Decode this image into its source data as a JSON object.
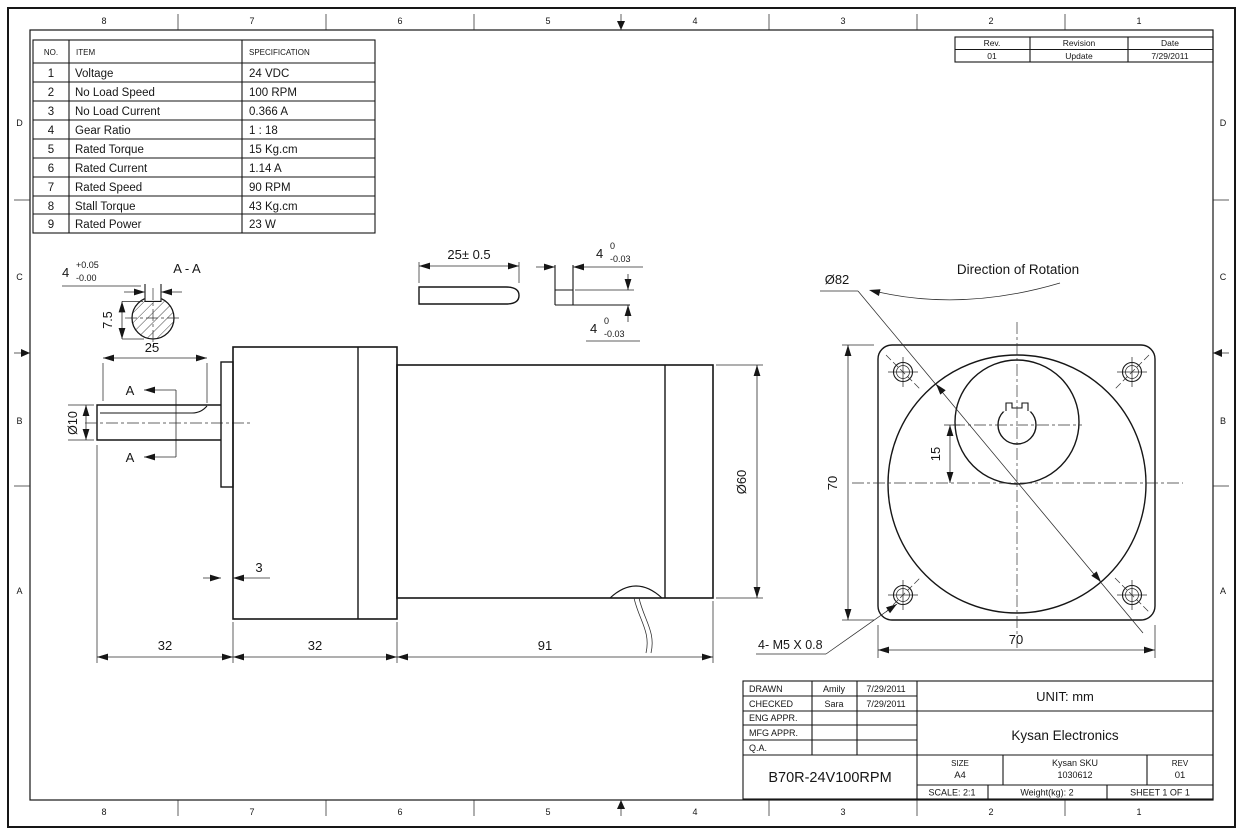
{
  "border": {
    "cols": [
      "8",
      "7",
      "6",
      "5",
      "4",
      "3",
      "2",
      "1"
    ],
    "rows": [
      "D",
      "C",
      "B",
      "A"
    ]
  },
  "spec_table": {
    "headers": [
      "NO.",
      "ITEM",
      "SPECIFICATION"
    ],
    "rows": [
      [
        "1",
        "Voltage",
        "24 VDC"
      ],
      [
        "2",
        "No Load Speed",
        "100 RPM"
      ],
      [
        "3",
        "No Load Current",
        "0.366 A"
      ],
      [
        "4",
        "Gear Ratio",
        "1 : 18"
      ],
      [
        "5",
        "Rated Torque",
        "15 Kg.cm"
      ],
      [
        "6",
        "Rated Current",
        "1.14 A"
      ],
      [
        "7",
        "Rated Speed",
        "90 RPM"
      ],
      [
        "8",
        "Stall Torque",
        "43 Kg.cm"
      ],
      [
        "9",
        "Rated Power",
        "23 W"
      ]
    ]
  },
  "revision_table": {
    "headers": [
      "Rev.",
      "Revision",
      "Date"
    ],
    "rows": [
      [
        "01",
        "Update",
        "7/29/2011"
      ]
    ]
  },
  "title_block": {
    "approvals": [
      [
        "DRAWN",
        "Amily",
        "7/29/2011"
      ],
      [
        "CHECKED",
        "Sara",
        "7/29/2011"
      ],
      [
        "ENG APPR.",
        "",
        ""
      ],
      [
        "MFG APPR.",
        "",
        ""
      ],
      [
        "Q.A.",
        "",
        ""
      ]
    ],
    "part_number": "B70R-24V100RPM",
    "unit": "UNIT: mm",
    "company": "Kysan Electronics",
    "size_label": "SIZE",
    "size_value": "A4",
    "sku_label": "Kysan SKU",
    "sku_value": "1030612",
    "rev_label": "REV",
    "rev_value": "01",
    "scale": "SCALE: 2:1",
    "weight": "Weight(kg): 2",
    "sheet": "SHEET 1 OF 1"
  },
  "dims": {
    "section_label": "A - A",
    "keyway_w_nom": "4",
    "keyway_w_plus": "+0.05",
    "keyway_w_minus": "-0.00",
    "keyway_depth": "7.5",
    "shaft_len": "25",
    "shaft_dia": "Ø10",
    "section_mark_top": "A",
    "section_mark_bottom": "A",
    "boss": "3",
    "len1": "32",
    "len2": "32",
    "len3": "91",
    "motor_dia": "Ø60",
    "key_len": "25± 0.5",
    "key_w_nom": "4",
    "key_w_plus": "0",
    "key_w_minus": "-0.03",
    "key_h_nom": "4",
    "key_h_plus": "0",
    "key_h_minus": "-0.03",
    "flange_dia": "Ø82",
    "flange_h": "70",
    "flange_w": "70",
    "shaft_offset": "15",
    "mounting_holes": "4- M5 X 0.8",
    "rotation_label": "Direction of Rotation"
  }
}
